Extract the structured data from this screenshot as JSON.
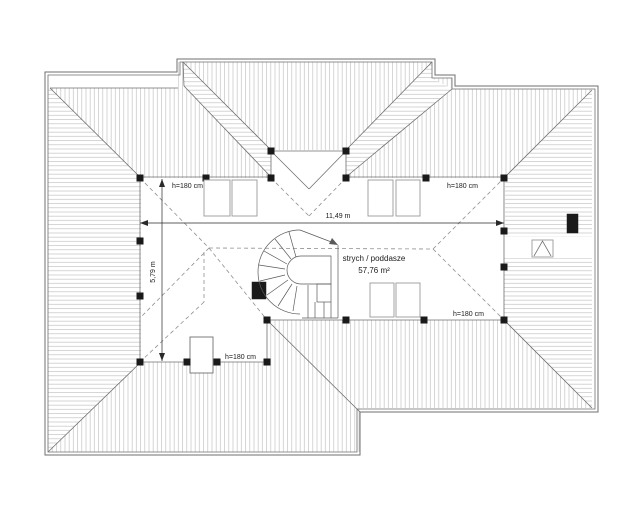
{
  "drawing": {
    "room_label": "strych / poddasze",
    "room_area": "57,76 m²",
    "dim_width": "11,49 m",
    "dim_depth": "5,79 m",
    "height_annotations": [
      "h=180 cm",
      "h=180 cm",
      "h=180 cm",
      "h=180 cm"
    ]
  },
  "colors": {
    "background": "#ffffff",
    "line": "#6f6f6f",
    "hatch": "#c3c3c3",
    "dash": "#8f8f8f",
    "ink": "#1a1a1a",
    "dim": "#2a2a2a",
    "light": "#9a9a9a",
    "stair": "#5a5a5a"
  }
}
